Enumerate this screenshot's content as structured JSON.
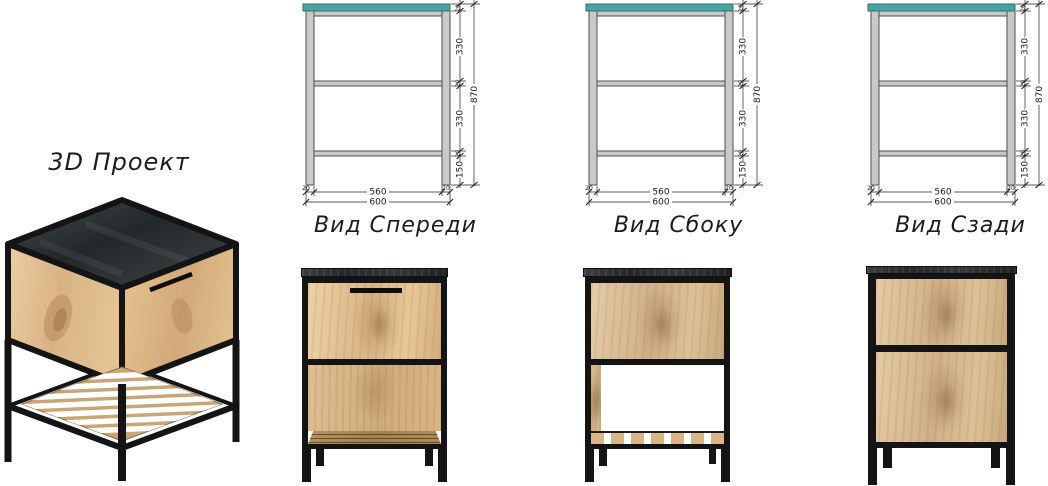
{
  "title": "3D Проект",
  "views": [
    {
      "label": "Вид Спереди"
    },
    {
      "label": "Вид Сбоку"
    },
    {
      "label": "Вид Сзади"
    }
  ],
  "dims": {
    "h_total": "870",
    "h_upper": "330",
    "h_lower": "330",
    "h_bottom": "150",
    "thickness": "20",
    "w_inner": "560",
    "w_total": "600"
  },
  "colors": {
    "top_panel_teal": "#47a59f",
    "frame_gray": "#c9c9c9",
    "metal_black": "#141414",
    "wood_light": "#dcb88a",
    "slab_dark": "#2b2f30"
  }
}
